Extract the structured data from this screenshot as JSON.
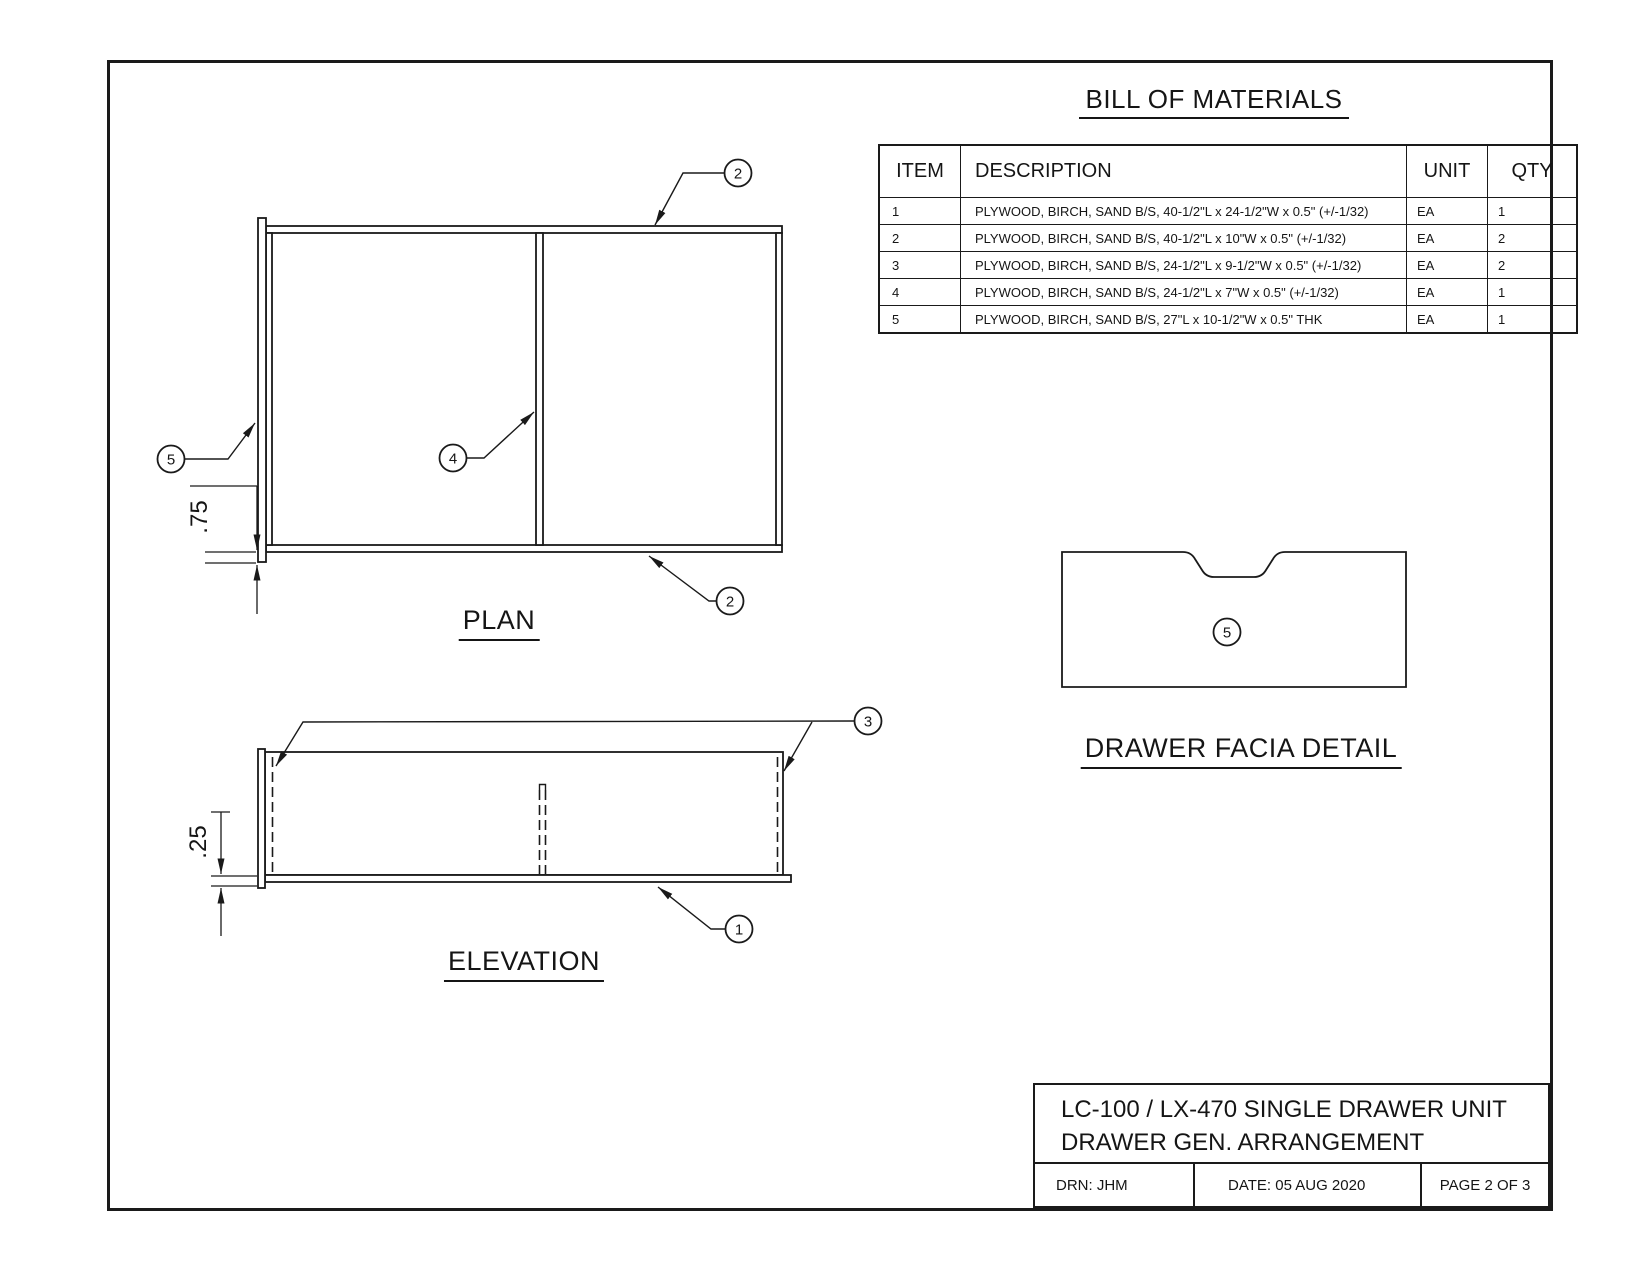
{
  "sheet": {
    "bom": {
      "title": "BILL OF MATERIALS",
      "headers": {
        "item": "ITEM",
        "description": "DESCRIPTION",
        "unit": "UNIT",
        "qty": "QTY"
      },
      "rows": [
        {
          "item": "1",
          "description": "PLYWOOD, BIRCH, SAND B/S,  40-1/2\"L x 24-1/2\"W x 0.5\"   (+/-1/32)",
          "unit": "EA",
          "qty": "1"
        },
        {
          "item": "2",
          "description": "PLYWOOD, BIRCH, SAND B/S,  40-1/2\"L x 10\"W x 0.5\"   (+/-1/32)",
          "unit": "EA",
          "qty": "2"
        },
        {
          "item": "3",
          "description": "PLYWOOD, BIRCH, SAND B/S,  24-1/2\"L x 9-1/2\"W x 0.5\"  (+/-1/32)",
          "unit": "EA",
          "qty": "2"
        },
        {
          "item": "4",
          "description": "PLYWOOD, BIRCH, SAND B/S,  24-1/2\"L x 7\"W x 0.5\"  (+/-1/32)",
          "unit": "EA",
          "qty": "1"
        },
        {
          "item": "5",
          "description": "PLYWOOD, BIRCH, SAND B/S,  27\"L x 10-1/2\"W x 0.5\" THK",
          "unit": "EA",
          "qty": "1"
        }
      ]
    },
    "views": {
      "plan": {
        "title": "PLAN",
        "dim": ".75",
        "balloons": {
          "top": "2",
          "bottom": "2",
          "divider": "4",
          "facia": "5"
        }
      },
      "elevation": {
        "title": "ELEVATION",
        "dim": ".25",
        "balloons": {
          "sides": "3",
          "bottom": "1"
        }
      },
      "facia": {
        "title": "DRAWER FACIA DETAIL",
        "balloon": "5"
      }
    },
    "title_block": {
      "line1": "LC-100 / LX-470 SINGLE DRAWER UNIT",
      "line2": "DRAWER GEN. ARRANGEMENT",
      "drn": "DRN: JHM",
      "date": "DATE: 05 AUG 2020",
      "page": "PAGE 2 OF 3"
    }
  }
}
